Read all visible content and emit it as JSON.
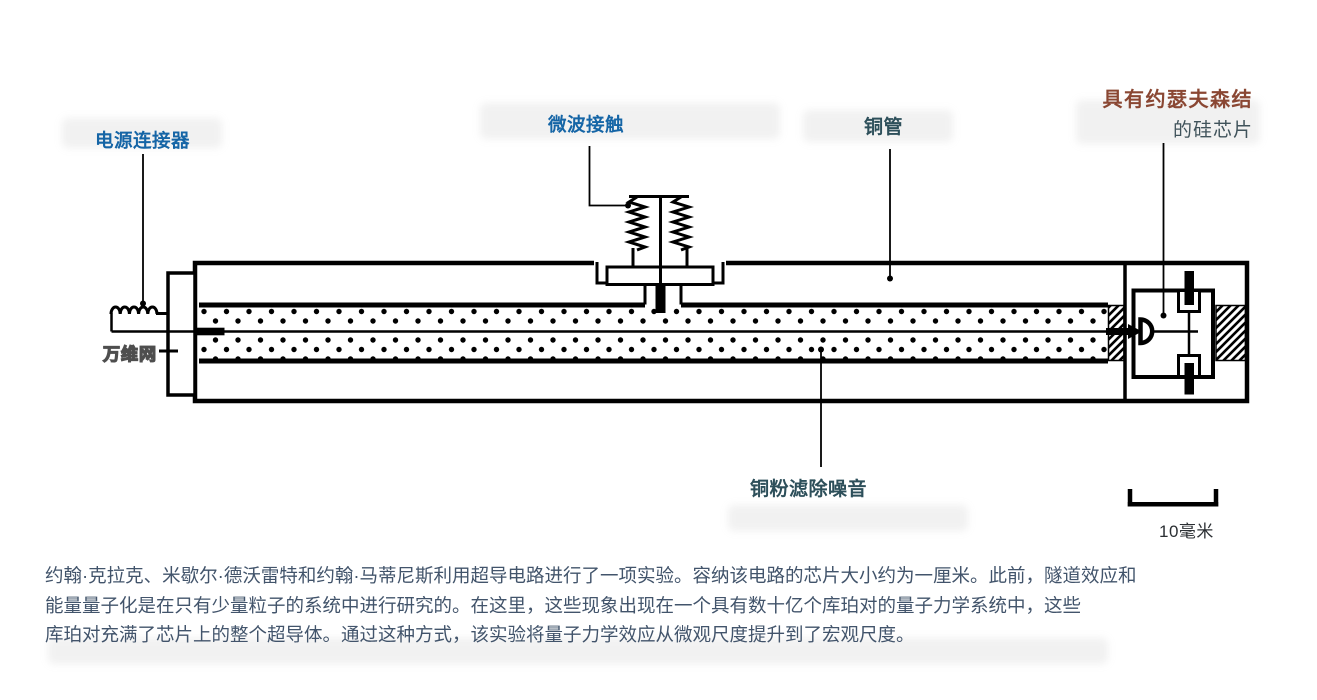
{
  "figure": {
    "background": "#ffffff",
    "line_color": "#000000"
  },
  "labels": {
    "power_connector": {
      "text": "电源连接器",
      "color": "#1565a6"
    },
    "microwave_contact": {
      "text": "微波接触",
      "color": "#1565a6"
    },
    "copper_tube": {
      "text": "铜管",
      "color": "#2d4f5a"
    },
    "chip_line1": {
      "text": "具有约瑟夫森结",
      "color": "#8a4733"
    },
    "chip_line2": {
      "text": "的硅芯片",
      "color": "#40535b"
    },
    "copper_powder": {
      "text": "铜粉滤除噪音",
      "color": "#2d4f5a"
    },
    "watermark": {
      "text": "万维网"
    },
    "scale_bar": {
      "text": "10毫米",
      "color": "#2b2f33"
    }
  },
  "caption": {
    "color": "#42546b",
    "lines": [
      "约翰·克拉克、米歇尔·德沃雷特和约翰·马蒂尼斯利用超导电路进行了一项实验。容纳该电路的芯片大小约为一厘米。此前，隧道效应和",
      "能量量子化是在只有少量粒子的系统中进行研究的。在这里，这些现象出现在一个具有数十亿个库珀对的量子力学系统中，这些",
      "库珀对充满了芯片上的整个超导体。通过这种方式，该实验将量子力学效应从微观尺度提升到了宏观尺度。"
    ]
  }
}
